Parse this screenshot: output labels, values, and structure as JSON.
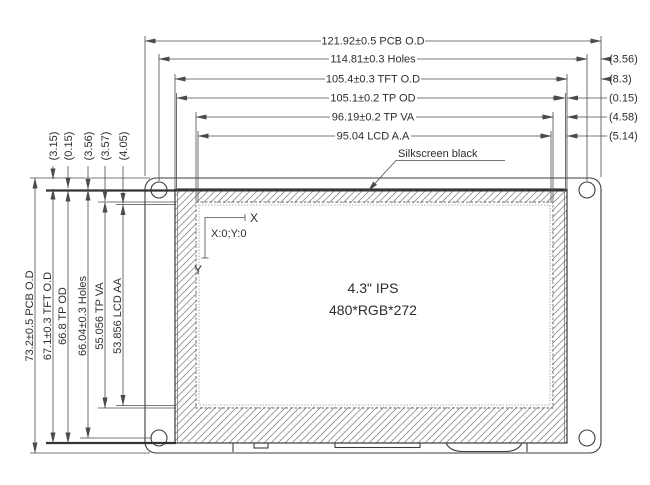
{
  "drawing": {
    "panel": {
      "size_label": "4.3\" IPS",
      "resolution_label": "480*RGB*272",
      "silkscreen_note": "Silkscreen black",
      "origin_label": "X:0;Y:0",
      "axis_x_label": "X",
      "axis_y_label": "Y"
    },
    "dims_top": [
      "121.92±0.5 PCB O.D",
      "114.81±0.3 Holes",
      "105.4±0.3 TFT O.D",
      "105.1±0.2 TP OD",
      "96.19±0.2 TP VA",
      "95.04 LCD A.A"
    ],
    "dims_right_offsets": [
      "(3.56)",
      "(8.3)",
      "(0.15)",
      "(4.58)",
      "(5.14)"
    ],
    "dims_left": [
      "73.2±0.5 PCB O.D",
      "67.1±0.3 TFT O.D",
      "66.8 TP OD",
      "66.04±0.3 Holes",
      "55.056 TP VA",
      "53.856 LCD AA"
    ],
    "dims_top_left_offsets": [
      "(3.15)",
      "(0.15)",
      "(3.56)",
      "(3.57)",
      "(4.05)"
    ],
    "colors": {
      "line": "#4b4b4b",
      "part_line": "#3c3c3c",
      "hatch": "#8f8f8f",
      "background": "#ffffff"
    }
  }
}
